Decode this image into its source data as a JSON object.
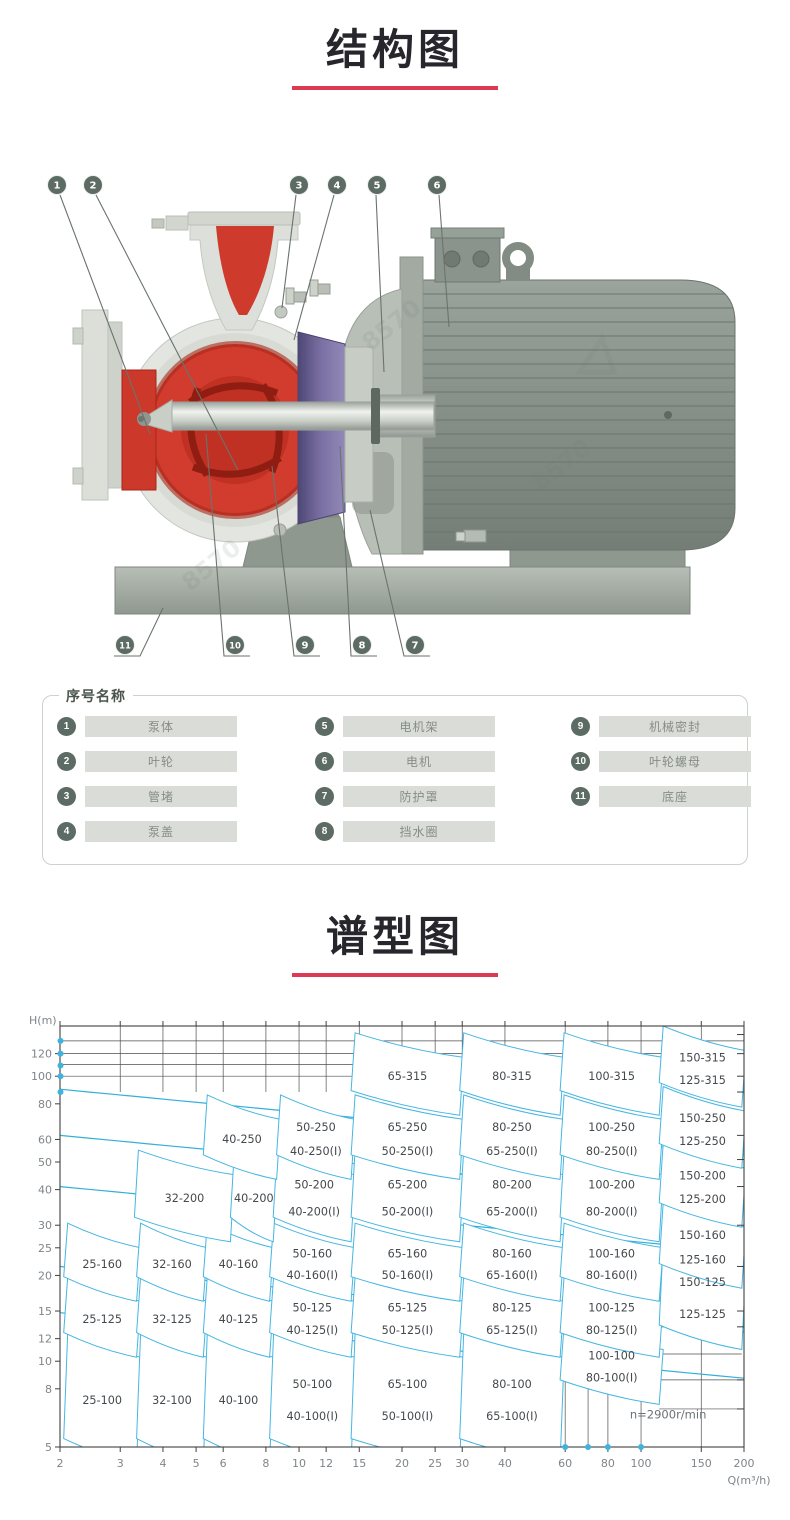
{
  "sections": {
    "structure_title": "结构图",
    "chart_title": "谱型图"
  },
  "pump": {
    "watermark": "8570",
    "callouts_top": [
      "1",
      "2",
      "3",
      "4",
      "5",
      "6"
    ],
    "callouts_bottom": [
      "11",
      "10",
      "9",
      "8",
      "7"
    ]
  },
  "legend": {
    "title": "序号名称",
    "items": [
      {
        "num": "1",
        "label": "泵体"
      },
      {
        "num": "2",
        "label": "叶轮"
      },
      {
        "num": "3",
        "label": "管堵"
      },
      {
        "num": "4",
        "label": "泵盖"
      },
      {
        "num": "5",
        "label": "电机架"
      },
      {
        "num": "6",
        "label": "电机"
      },
      {
        "num": "7",
        "label": "防护罩"
      },
      {
        "num": "8",
        "label": "挡水圈"
      },
      {
        "num": "9",
        "label": "机械密封"
      },
      {
        "num": "10",
        "label": "叶轮螺母"
      },
      {
        "num": "11",
        "label": "底座"
      }
    ]
  },
  "chart_data": {
    "type": "area",
    "title": "谱型图",
    "xlabel": "Q(m³/h)",
    "ylabel": "H(m)",
    "x_scale": "log",
    "y_scale": "log",
    "xlim": [
      2,
      200
    ],
    "ylim": [
      5,
      148
    ],
    "x_ticks": [
      2,
      3,
      4,
      5,
      6,
      8,
      10,
      12,
      15,
      20,
      25,
      30,
      40,
      60,
      80,
      100,
      150,
      200
    ],
    "y_ticks": [
      120,
      100,
      80,
      60,
      50,
      40,
      30,
      25,
      20,
      15,
      12,
      10,
      8,
      5
    ],
    "annotation": "n=2900r/min",
    "annotation_pos": {
      "q": 120,
      "h": 6.3
    },
    "regions": [
      {
        "labels": [
          "25-100"
        ],
        "q": [
          2.05,
          3.35
        ],
        "h": [
          5.35,
          12.6
        ]
      },
      {
        "labels": [
          "32-100"
        ],
        "q": [
          3.35,
          5.25
        ],
        "h": [
          5.35,
          12.6
        ]
      },
      {
        "labels": [
          "40-100"
        ],
        "q": [
          5.25,
          8.2
        ],
        "h": [
          5.35,
          12.6
        ]
      },
      {
        "labels": [
          "50-100",
          "40-100(I)"
        ],
        "q": [
          8.2,
          14.2
        ],
        "h": [
          5.35,
          12.6
        ]
      },
      {
        "labels": [
          "65-100",
          "50-100(I)"
        ],
        "q": [
          14.2,
          29.5
        ],
        "h": [
          5.35,
          12.6
        ]
      },
      {
        "labels": [
          "80-100",
          "65-100(I)"
        ],
        "q": [
          29.5,
          58
        ],
        "h": [
          5.35,
          12.6
        ]
      },
      {
        "labels": [
          "100-100",
          "80-100(I)"
        ],
        "q": [
          58,
          113
        ],
        "h": [
          8.6,
          13.4
        ]
      },
      {
        "labels": [
          "25-125"
        ],
        "q": [
          2.05,
          3.35
        ],
        "h": [
          12.6,
          19.8
        ]
      },
      {
        "labels": [
          "32-125"
        ],
        "q": [
          3.35,
          5.25
        ],
        "h": [
          12.6,
          19.8
        ]
      },
      {
        "labels": [
          "40-125"
        ],
        "q": [
          5.25,
          8.2
        ],
        "h": [
          12.6,
          19.8
        ]
      },
      {
        "labels": [
          "50-125",
          "40-125(I)"
        ],
        "q": [
          8.2,
          14.2
        ],
        "h": [
          12.6,
          19.8
        ]
      },
      {
        "labels": [
          "65-125",
          "50-125(I)"
        ],
        "q": [
          14.2,
          29.5
        ],
        "h": [
          12.6,
          19.8
        ]
      },
      {
        "labels": [
          "80-125",
          "65-125(I)"
        ],
        "q": [
          29.5,
          58
        ],
        "h": [
          12.6,
          19.8
        ]
      },
      {
        "labels": [
          "100-125",
          "80-125(I)"
        ],
        "q": [
          58,
          113
        ],
        "h": [
          12.6,
          19.8
        ]
      },
      {
        "labels": [
          "150-125",
          "125-125"
        ],
        "q": [
          113,
          197
        ],
        "h": [
          13.4,
          26
        ]
      },
      {
        "labels": [
          "25-160"
        ],
        "q": [
          2.05,
          3.35
        ],
        "h": [
          19.8,
          30.5
        ]
      },
      {
        "labels": [
          "32-160"
        ],
        "q": [
          3.35,
          5.25
        ],
        "h": [
          19.8,
          30.5
        ]
      },
      {
        "labels": [
          "40-160"
        ],
        "q": [
          5.25,
          8.2
        ],
        "h": [
          19.8,
          30.5
        ]
      },
      {
        "labels": [
          "50-160",
          "40-160(I)"
        ],
        "q": [
          8.2,
          14.2
        ],
        "h": [
          19.8,
          30.5
        ]
      },
      {
        "labels": [
          "65-160",
          "50-160(I)"
        ],
        "q": [
          14.2,
          29.5
        ],
        "h": [
          19.8,
          30.5
        ]
      },
      {
        "labels": [
          "80-160",
          "65-160(I)"
        ],
        "q": [
          29.5,
          58
        ],
        "h": [
          19.8,
          30.5
        ]
      },
      {
        "labels": [
          "100-160",
          "80-160(I)"
        ],
        "q": [
          58,
          113
        ],
        "h": [
          19.8,
          30.5
        ]
      },
      {
        "labels": [
          "150-160",
          "125-160"
        ],
        "q": [
          113,
          197
        ],
        "h": [
          22,
          36
        ]
      },
      {
        "labels": [
          "32-200"
        ],
        "q": [
          3.3,
          6.3
        ],
        "h": [
          32,
          55
        ]
      },
      {
        "labels": [
          "40-200"
        ],
        "q": [
          6.3,
          8.4
        ],
        "h": [
          32,
          55
        ]
      },
      {
        "labels": [
          "50-200",
          "40-200(I)"
        ],
        "q": [
          8.4,
          14.2
        ],
        "h": [
          32,
          55
        ]
      },
      {
        "labels": [
          "65-200",
          "50-200(I)"
        ],
        "q": [
          14.2,
          29.5
        ],
        "h": [
          32,
          55
        ]
      },
      {
        "labels": [
          "80-200",
          "65-200(I)"
        ],
        "q": [
          29.5,
          58
        ],
        "h": [
          32,
          55
        ]
      },
      {
        "labels": [
          "100-200",
          "80-200(I)"
        ],
        "q": [
          58,
          113
        ],
        "h": [
          32,
          55
        ]
      },
      {
        "labels": [
          "150-200",
          "125-200"
        ],
        "q": [
          113,
          197
        ],
        "h": [
          36,
          58
        ]
      },
      {
        "labels": [
          "40-250"
        ],
        "q": [
          5.25,
          8.6
        ],
        "h": [
          53,
          86
        ]
      },
      {
        "labels": [
          "50-250",
          "40-250(I)"
        ],
        "q": [
          8.6,
          14.2
        ],
        "h": [
          53,
          86
        ]
      },
      {
        "labels": [
          "65-250",
          "50-250(I)"
        ],
        "q": [
          14.2,
          29.5
        ],
        "h": [
          53,
          86
        ]
      },
      {
        "labels": [
          "80-250",
          "65-250(I)"
        ],
        "q": [
          29.5,
          58
        ],
        "h": [
          53,
          86
        ]
      },
      {
        "labels": [
          "100-250",
          "80-250(I)"
        ],
        "q": [
          58,
          113
        ],
        "h": [
          53,
          86
        ]
      },
      {
        "labels": [
          "150-250",
          "125-250"
        ],
        "q": [
          113,
          197
        ],
        "h": [
          58,
          92
        ]
      },
      {
        "labels": [
          "65-315"
        ],
        "q": [
          14.2,
          29.5
        ],
        "h": [
          89,
          142
        ]
      },
      {
        "labels": [
          "80-315"
        ],
        "q": [
          29.5,
          58
        ],
        "h": [
          89,
          142
        ]
      },
      {
        "labels": [
          "100-315"
        ],
        "q": [
          58,
          113
        ],
        "h": [
          89,
          142
        ]
      },
      {
        "labels": [
          "150-315",
          "125-315"
        ],
        "q": [
          113,
          197
        ],
        "h": [
          95,
          150
        ]
      }
    ],
    "envelope_start_h": [
      90,
      62,
      41,
      21.5,
      14.8
    ],
    "grid": {
      "top_h_lines": [
        100,
        110,
        120,
        133
      ],
      "top_v_lines_q": [
        3,
        4,
        5,
        6,
        8,
        10,
        12,
        15,
        20,
        25,
        30,
        40,
        60,
        80,
        100,
        150
      ],
      "bottom_v_lines_q": [
        60,
        70,
        80,
        100
      ],
      "bottom_v_top_h": 13.4,
      "right_h_lines": [
        6.8,
        8.6,
        10.6,
        13.2
      ],
      "right_h_q": [
        113,
        197
      ],
      "extra_v_q": 150,
      "right_ticks_h": [
        140,
        120,
        100,
        88,
        62,
        51,
        41,
        30,
        21.5,
        15,
        13.2,
        8.6,
        6.8
      ]
    },
    "axis_dots": {
      "left_h": [
        133,
        120,
        109,
        100,
        88
      ],
      "bottom_q": [
        60,
        70,
        80,
        100
      ]
    },
    "colors": {
      "region_line": "#45b6e2",
      "envelope": "#35aed8",
      "grid": "#4f4f4f",
      "frame": "#3f3f3f",
      "label": "#44494d",
      "tick_text": "#7f8589",
      "dot": "#3fb3de",
      "accent_underline": "#dc3a52"
    }
  }
}
